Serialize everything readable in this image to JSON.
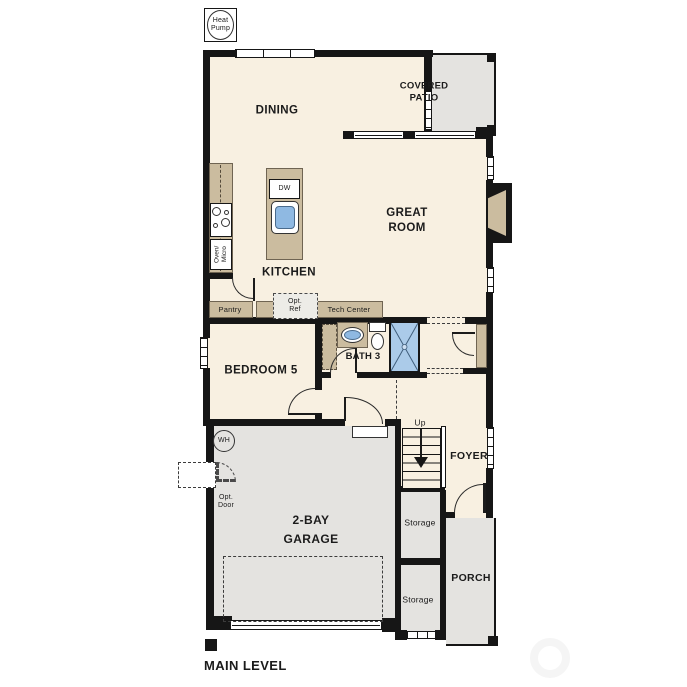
{
  "title": {
    "label": "MAIN LEVEL"
  },
  "colors": {
    "wall": "#161616",
    "floor": "#f8f0e1",
    "outdoor": "#e4e3e0",
    "counter": "#cbbc9f",
    "shower_fill": "#abcbe9",
    "sink_fill": "#8fb9e2"
  },
  "rooms": {
    "dining": {
      "label": "DINING"
    },
    "covered_patio": {
      "label": "COVERED\nPATIO"
    },
    "great_room": {
      "label": "GREAT\nROOM"
    },
    "kitchen": {
      "label": "KITCHEN"
    },
    "bedroom_5": {
      "label": "BEDROOM 5"
    },
    "bath_3": {
      "label": "BATH 3"
    },
    "foyer": {
      "label": "FOYER"
    },
    "garage": {
      "label": "2-BAY\nGARAGE"
    },
    "porch": {
      "label": "PORCH"
    },
    "storage_upper": {
      "label": "Storage"
    },
    "storage_lower": {
      "label": "Storage"
    }
  },
  "annotations": {
    "heat_pump": "Heat\nPump",
    "dishwasher": "DW",
    "oven_micro": "Oven/\nMicro",
    "pantry": "Pantry",
    "opt_ref": "Opt.\nRef",
    "tech_center": "Tech Center",
    "water_heater": "WH",
    "opt_door": "Opt.\nDoor",
    "stairs_up": "Up"
  }
}
